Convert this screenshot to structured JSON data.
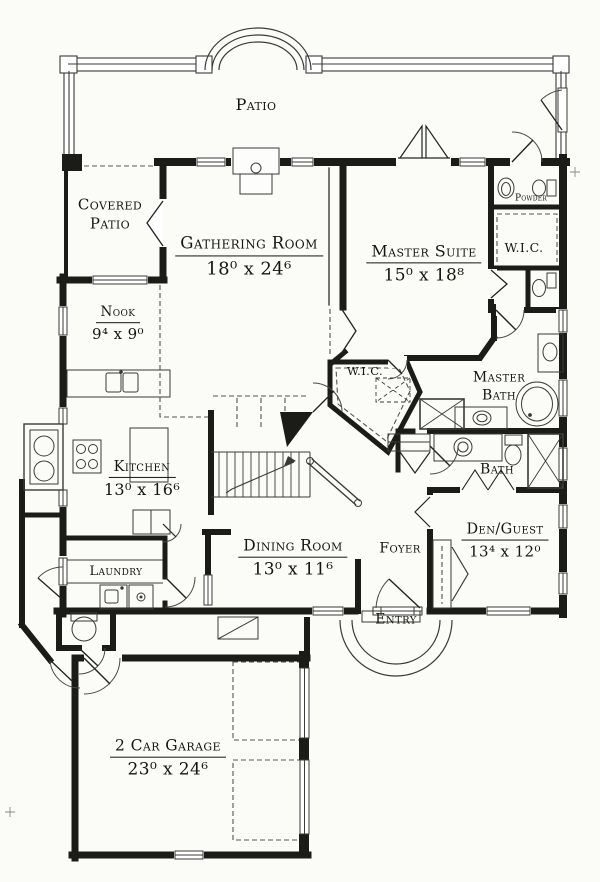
{
  "document": {
    "kind": "house-first-floor-plan"
  },
  "colors": {
    "ink": "#1b1b17",
    "paper": "#fbfbf8",
    "thin": "#3a3a36"
  },
  "rooms": {
    "patio": {
      "name": "Patio"
    },
    "covered_patio": {
      "name": "Covered Patio"
    },
    "gathering_room": {
      "name": "Gathering Room",
      "dims": "18⁰ x 24⁶"
    },
    "master_suite": {
      "name": "Master Suite",
      "dims": "15⁰ x 18⁸"
    },
    "powder": {
      "name": "Powder"
    },
    "wic_master": {
      "name": "W.I.C."
    },
    "nook": {
      "name": "Nook",
      "dims": "9⁴ x 9⁰"
    },
    "wic_hall": {
      "name": "W.I.C."
    },
    "master_bath": {
      "line1": "Master",
      "line2": "Bath"
    },
    "kitchen": {
      "name": "Kitchen",
      "dims": "13⁰ x 16⁶"
    },
    "bath": {
      "name": "Bath"
    },
    "dining_room": {
      "name": "Dining Room",
      "dims": "13⁰ x 11⁶"
    },
    "foyer": {
      "name": "Foyer"
    },
    "den_guest": {
      "name": "Den/Guest",
      "dims": "13⁴ x 12⁰"
    },
    "laundry": {
      "name": "Laundry"
    },
    "entry": {
      "name": "Entry"
    },
    "garage": {
      "name": "2 Car Garage",
      "dims": "23⁰ x 24⁶"
    }
  }
}
